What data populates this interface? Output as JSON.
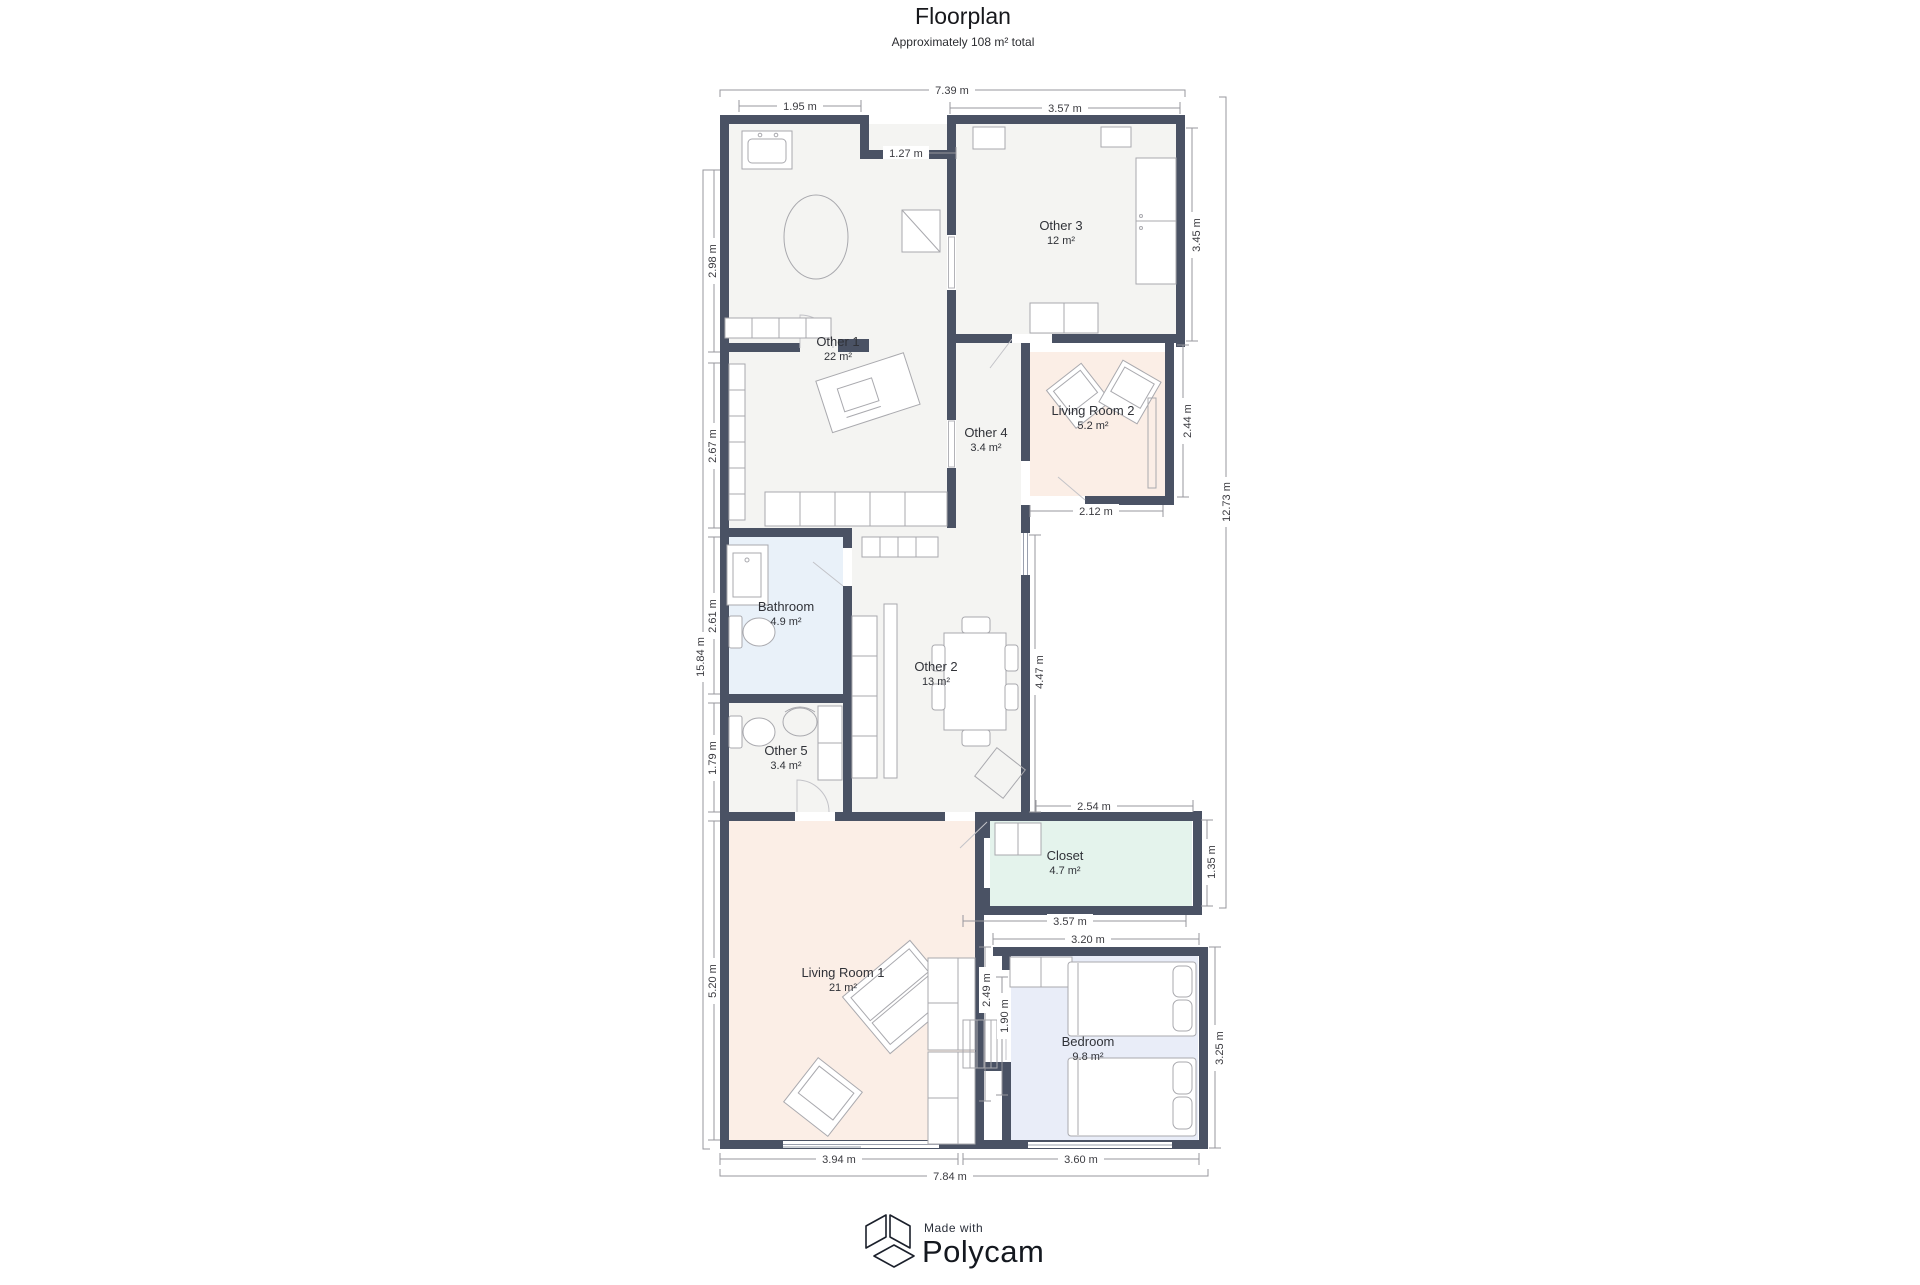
{
  "header": {
    "title": "Floorplan",
    "subtitle": "Approximately 108 m² total"
  },
  "rooms": {
    "other1": {
      "name": "Other 1",
      "area": "22 m²"
    },
    "other3": {
      "name": "Other 3",
      "area": "12 m²"
    },
    "living2": {
      "name": "Living Room 2",
      "area": "5.2 m²"
    },
    "other4": {
      "name": "Other 4",
      "area": "3.4 m²"
    },
    "bathroom": {
      "name": "Bathroom",
      "area": "4.9 m²"
    },
    "other2": {
      "name": "Other 2",
      "area": "13 m²"
    },
    "other5": {
      "name": "Other 5",
      "area": "3.4 m²"
    },
    "closet": {
      "name": "Closet",
      "area": "4.7 m²"
    },
    "living1": {
      "name": "Living Room 1",
      "area": "21 m²"
    },
    "bedroom": {
      "name": "Bedroom",
      "area": "9.8 m²"
    }
  },
  "dimensions": {
    "top_total": "7.39 m",
    "top_left": "1.95 m",
    "top_door": "1.27 m",
    "top_right": "3.57 m",
    "left_total": "15.84 m",
    "left_1": "2.98 m",
    "left_2": "2.67 m",
    "left_3": "2.61 m",
    "left_4": "1.79 m",
    "left_5": "5.20 m",
    "right_total": "12.73 m",
    "right_other3": "3.45 m",
    "right_living2": "2.44 m",
    "right_closet": "1.35 m",
    "right_bedroom": "3.25 m",
    "mid_living2": "2.12 m",
    "mid_other2": "4.47 m",
    "closet_top": "2.54 m",
    "closet_bottom": "3.57 m",
    "bedroom_top": "3.20 m",
    "bedroom_left_1": "2.49 m",
    "bedroom_left_2": "1.90 m",
    "bottom_left": "3.94 m",
    "bottom_right": "3.60 m",
    "bottom_total": "7.84 m"
  },
  "footer": {
    "made_with": "Made with",
    "brand": "Polycam"
  },
  "colors": {
    "wall": "#4a5264",
    "room_gray": "#f4f4f2",
    "living_peach": "#fbeee6",
    "bathroom_blue": "#e9f1f9",
    "closet_mint": "#e4f3ec",
    "bedroom_lavender": "#e9edf8"
  }
}
